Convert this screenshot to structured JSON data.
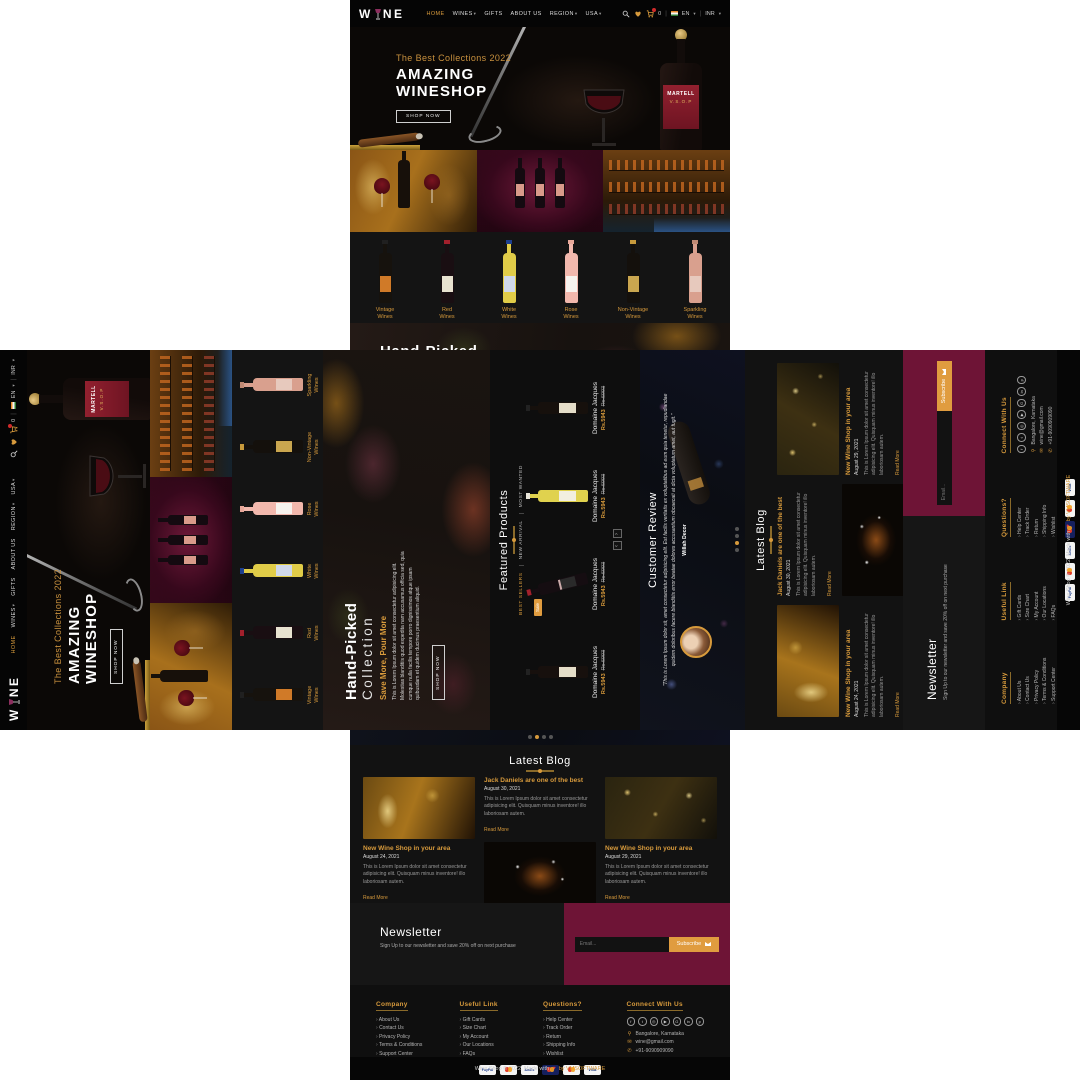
{
  "theme": {
    "accent": "#d79a3c",
    "maroon": "#6e1436",
    "page_bg": "#0c0c0c"
  },
  "header": {
    "logo_part1": "W",
    "logo_part2": "NE",
    "nav": [
      {
        "label": "HOME",
        "active": true,
        "dropdown": false
      },
      {
        "label": "WINES",
        "active": false,
        "dropdown": true
      },
      {
        "label": "GIFTS",
        "active": false,
        "dropdown": false
      },
      {
        "label": "ABOUT US",
        "active": false,
        "dropdown": false
      },
      {
        "label": "REGION",
        "active": false,
        "dropdown": true
      },
      {
        "label": "USA",
        "active": false,
        "dropdown": true
      }
    ],
    "cart_count": "0",
    "lang": "EN",
    "currency": "INR"
  },
  "hero": {
    "tagline": "The Best Collections 2022",
    "title_line1": "AMAZING",
    "title_line2": "WINESHOP",
    "cta": "SHOP NOW",
    "bottle_brand": "MARTELL",
    "bottle_variant": "V.S.O.P"
  },
  "categories": [
    {
      "line1": "Vintage",
      "line2": "Wines"
    },
    {
      "line1": "Red",
      "line2": "Wines"
    },
    {
      "line1": "White",
      "line2": "Wines"
    },
    {
      "line1": "Rose",
      "line2": "Wines"
    },
    {
      "line1": "Non-Vintage",
      "line2": "Wines"
    },
    {
      "line1": "Sparkling",
      "line2": "Wines"
    }
  ],
  "handpicked": {
    "title_line1": "Hand-Picked",
    "title_line2": "Collection",
    "subtitle": "Save More, Pour More",
    "body": "This is Lorem Ipsum dolor sit amet consectetur adipisicing elit. Molestias blanditiis quod expedita nam accusamus officia sed, quia cumque nulla facilis tempore porro dignissimos atque ipsam quibusdam et quidem ducimus praesentium aliquid.",
    "cta": "SHOP NOW"
  },
  "featured": {
    "heading": "Featured Products",
    "tabs": [
      "BEST SELLERS",
      "NEW ARRIVAL",
      "MOST WANTED"
    ],
    "sale_badge": "Sale",
    "products": [
      {
        "name": "Domaine Jacques",
        "price": "Rs.5943",
        "old_price": "Rs.6993"
      },
      {
        "name": "Domaine Jacques",
        "price": "Rs.5943",
        "old_price": "Rs.6993"
      },
      {
        "name": "Domaine Jacques",
        "price": "Rs.5943",
        "old_price": "Rs.6993"
      },
      {
        "name": "Domaine Jacques",
        "price": "Rs.5943",
        "old_price": "Rs.6993"
      }
    ]
  },
  "review": {
    "heading": "Customer Review",
    "quote": "\"This is Lorem Ipsum dolor sit, amet consectetur adipisicing elit. Est facilis veritatis ex voluptatibus ad eum quia tenetur, repudiandae quidem doloribus facere blanditiis error beatae dolores accusantium obcaecati at dicta voluptatum amet, aut fugit.\"",
    "author": "Willah Decor"
  },
  "blog": {
    "heading": "Latest Blog",
    "read_more": "Read More",
    "posts": [
      {
        "title": "Jack Daniels are one of the best",
        "date": "August 30, 2021",
        "excerpt": "This is Lorem Ipsum dolor sit amet consectetur adipisicing elit. Quisquam minus inventore! illo laboriosam autem."
      },
      {
        "title": "New Wine Shop in your area",
        "date": "August 24, 2021",
        "excerpt": "This is Lorem Ipsum dolor sit amet consectetur adipisicing elit. Quisquam minus inventore! illo laboriosam autem."
      },
      {
        "title": "New Wine Shop in your area",
        "date": "August 29, 2021",
        "excerpt": "This is Lorem Ipsum dolor sit amet consectetur adipisicing elit. Quisquam minus inventore! illo laboriosam autem."
      }
    ]
  },
  "newsletter": {
    "heading": "Newsletter",
    "subtext": "Sign Up to our newsletter and save 20% off on next purchase",
    "placeholder": "Email...",
    "button": "Subscribe"
  },
  "footer": {
    "columns": [
      {
        "title": "Company",
        "links": [
          "About Us",
          "Contact Us",
          "Privacy Policy",
          "Terms & Conditions",
          "Support Center"
        ]
      },
      {
        "title": "Useful Link",
        "links": [
          "Gift Cards",
          "Size Chart",
          "My Account",
          "Our Locations",
          "FAQs"
        ]
      },
      {
        "title": "Questions?",
        "links": [
          "Help Center",
          "Track Order",
          "Return",
          "Shipping Info",
          "Wishlist"
        ]
      }
    ],
    "connect": {
      "title": "Connect With Us",
      "location": "Bangalore, Karnataka",
      "email": "wine@gmail.com",
      "phone": "+91-9090909090"
    },
    "socials": [
      "facebook",
      "twitter",
      "instagram",
      "youtube",
      "google-plus",
      "linkedin",
      "pinterest"
    ],
    "payments": [
      "PayPal",
      "MasterCard",
      "AmEx",
      "Maestro",
      "MasterCard",
      "VISA"
    ],
    "copyright_pre": "Wine Shop © 2022. Made with",
    "copyright_post": "by VMSOFTWARE"
  },
  "icons": {
    "search": "magnifier",
    "wishlist": "heart",
    "cart": "shopping-cart",
    "lang_flag": "india-flag",
    "dropdown": "chevron-down",
    "subscribe": "envelope",
    "location": "map-pin",
    "mail": "envelope",
    "phone": "phone",
    "made_with": "heart"
  }
}
